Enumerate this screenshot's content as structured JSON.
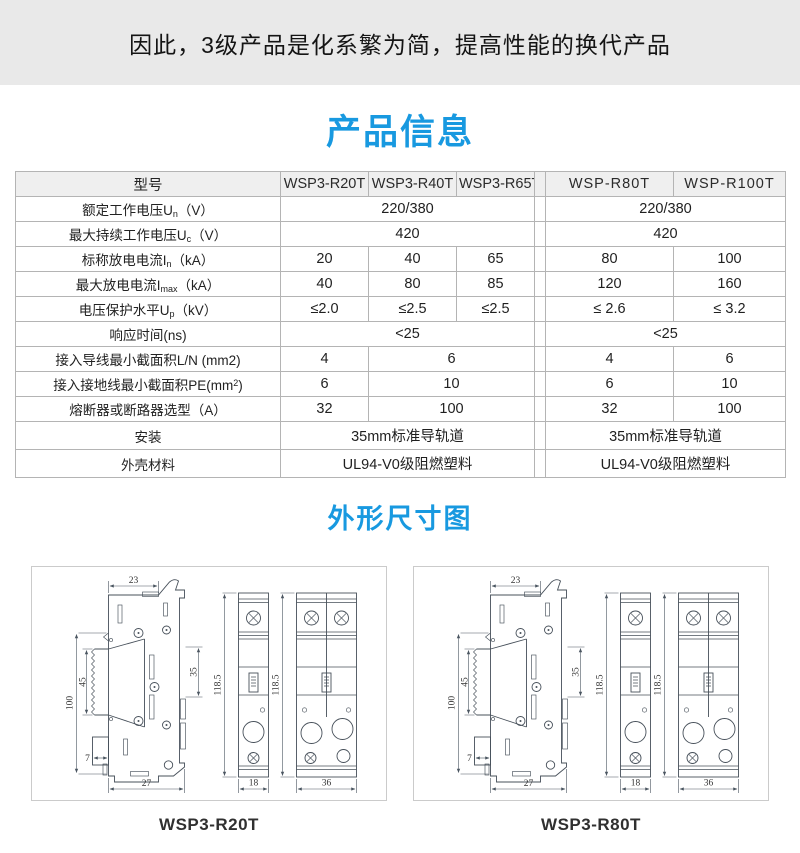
{
  "banner": {
    "text": "因此，3级产品是化系繁为简，提高性能的换代产品"
  },
  "product_info": {
    "title": "产品信息",
    "table": {
      "header": {
        "label": "型号",
        "models": [
          "WSP3-R20T",
          "WSP3-R40T",
          "WSP3-R65T",
          "WSP-R80T",
          "WSP-R100T"
        ]
      },
      "rows": [
        {
          "label": {
            "pre": "额定工作电压U",
            "sub": "n",
            "post": "（V）"
          },
          "cells": {
            "g1": "220/380",
            "g2": "220/380"
          }
        },
        {
          "label": {
            "pre": "最大持续工作电压U",
            "sub": "c",
            "post": "（V）"
          },
          "cells": {
            "g1": "420",
            "g2": "420"
          }
        },
        {
          "label": {
            "pre": "标称放电电流I",
            "sub": "n",
            "post": "（kA）"
          },
          "cells": {
            "c1": "20",
            "c2": "40",
            "c3": "65",
            "c4": "80",
            "c5": "100"
          }
        },
        {
          "label": {
            "pre": "最大放电电流I",
            "sub": "max",
            "post": "（kA）"
          },
          "cells": {
            "c1": "40",
            "c2": "80",
            "c3": "85",
            "c4": "120",
            "c5": "160"
          }
        },
        {
          "label": {
            "pre": "电压保护水平U",
            "sub": "p",
            "post": "（kV）"
          },
          "cells": {
            "c1": "≤2.0",
            "c2": "≤2.5",
            "c3": "≤2.5",
            "c4": "≤ 2.6",
            "c5": "≤ 3.2"
          }
        },
        {
          "label": {
            "pre": "响应时间(ns)"
          },
          "cells": {
            "g1": "<25",
            "g2": "<25"
          }
        },
        {
          "label": {
            "pre": "接入导线最小截面积L/N (mm2)"
          },
          "cells": {
            "c1": "4",
            "c23": "6",
            "c4": "4",
            "c5": "6"
          }
        },
        {
          "label": {
            "pre": "接入接地线最小截面积PE(mm",
            "sup": "2",
            "post": ")"
          },
          "cells": {
            "c1": "6",
            "c23": "10",
            "c4": "6",
            "c5": "10"
          }
        },
        {
          "label": {
            "pre": "熔断器或断路器选型（A）"
          },
          "cells": {
            "c1": "32",
            "c23": "100",
            "c4": "32",
            "c5": "100"
          }
        },
        {
          "label": {
            "pre": "安装"
          },
          "cells": {
            "g1": "35mm标准导轨道",
            "g2": "35mm标准导轨道"
          }
        },
        {
          "label": {
            "pre": "外壳材料"
          },
          "cells": {
            "g1": "UL94-V0级阻燃塑料",
            "g2": "UL94-V0级阻燃塑料"
          }
        }
      ]
    }
  },
  "dimensions": {
    "title": "外形尺寸图",
    "panels": [
      {
        "label": "WSP3-R20T",
        "dims": {
          "top": "23",
          "outer_left": "100",
          "inner_left": "45",
          "right": "35",
          "foot": "7",
          "bottom": "27",
          "front_height": "118.5",
          "narrow_width": "18",
          "wide_width": "36"
        }
      },
      {
        "label": "WSP3-R80T",
        "dims": {
          "top": "23",
          "outer_left": "100",
          "inner_left": "45",
          "right": "35",
          "foot": "7",
          "bottom": "27",
          "front_height": "118.5",
          "narrow_width": "18",
          "wide_width": "36"
        }
      }
    ]
  },
  "colors": {
    "accent_blue": "#1899e0",
    "banner_gray": "#e9e9e9"
  }
}
